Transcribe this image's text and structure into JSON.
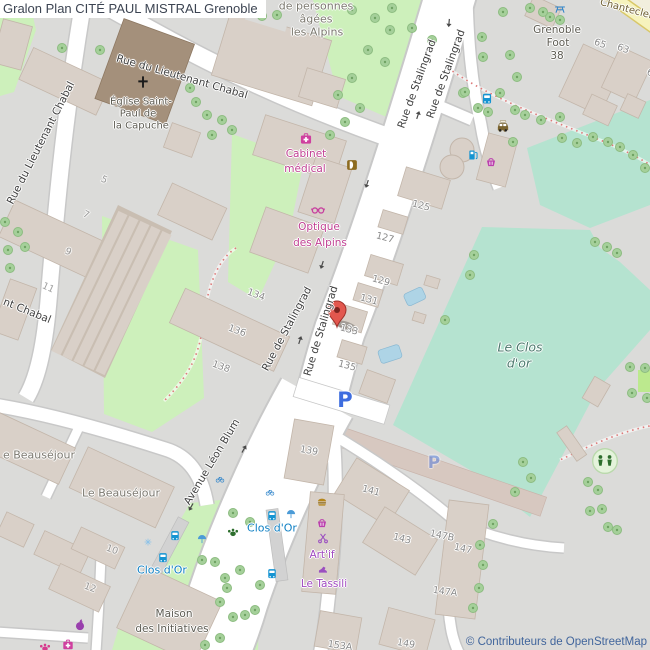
{
  "header": {
    "title": "Gralon Plan CITÉ PAUL MISTRAL Grenoble"
  },
  "attribution": {
    "text": "© Contributeurs de OpenStreetMap"
  },
  "colors": {
    "base": "#dbdbd9",
    "road": "#ffffff",
    "road_casing": "#c8c8c8",
    "building": "#d9d0c8",
    "church": "#a4907b",
    "grass": "#cdf0bb",
    "sports_field": "#b5e3d0",
    "yellow_road": "#f6f3bd",
    "tree": "#a5d09a",
    "pool_blue": "#aed4e6",
    "path_dashed": "#dd7a7a",
    "poi_pink": "#cf3f9f",
    "poi_purple": "#9b4fc0",
    "transit_blue": "#1080c4",
    "parking_blue": "#3e6ddf",
    "marker_red": "#e2574e"
  },
  "map": {
    "marker": {
      "x": 337,
      "y": 327
    },
    "labels": [
      {
        "name": "street-rue-du-lieutenant-chabal-top",
        "text": "Rue du Lieutenant Chabal",
        "x": 182,
        "y": 77,
        "r": 16,
        "cls": "street"
      },
      {
        "name": "street-rue-du-lieutenant-chabal-west",
        "text": "Rue du Lieutenant Chabal",
        "x": 41,
        "y": 143,
        "r": -63,
        "cls": "street"
      },
      {
        "name": "street-nt-chabal",
        "text": "nt Chabal",
        "x": 27,
        "y": 311,
        "r": 22,
        "cls": "street"
      },
      {
        "name": "street-rue-de-stalingrad-nw",
        "text": "Rue de Stalingrad",
        "x": 417,
        "y": 84,
        "r": -70,
        "cls": "street"
      },
      {
        "name": "street-rue-de-stalingrad-ne",
        "text": "Rue de Stalingrad",
        "x": 446,
        "y": 74,
        "r": -70,
        "cls": "street"
      },
      {
        "name": "street-rue-de-stalingrad-sw",
        "text": "Rue de Stalingrad",
        "x": 287,
        "y": 329,
        "r": -62,
        "cls": "street"
      },
      {
        "name": "street-rue-de-stalingrad-se",
        "text": "Rue de Stalingrad",
        "x": 321,
        "y": 331,
        "r": -73,
        "cls": "street"
      },
      {
        "name": "street-avenue-leon-blum",
        "text": "Avenue Léon Blum",
        "x": 212,
        "y": 462,
        "r": -59,
        "cls": "street"
      },
      {
        "name": "street-chanteclerc",
        "text": "Chanteclerc",
        "x": 629,
        "y": 10,
        "r": 15,
        "cls": "chant"
      },
      {
        "name": "place-de-personnes",
        "text": "de personnes",
        "x": 316,
        "y": 6,
        "r": 0,
        "cls": "place"
      },
      {
        "name": "place-agees",
        "text": "âgées",
        "x": 316,
        "y": 19,
        "r": 0,
        "cls": "place"
      },
      {
        "name": "place-les-alpins",
        "text": "les Alpins",
        "x": 317,
        "y": 32,
        "r": 0,
        "cls": "place"
      },
      {
        "name": "place-eglise-line1",
        "text": "Église Saint-",
        "x": 141,
        "y": 102,
        "r": 0,
        "cls": "placedark",
        "size": 10
      },
      {
        "name": "place-eglise-line2",
        "text": "Paul de",
        "x": 138,
        "y": 114,
        "r": 0,
        "cls": "placedark",
        "size": 10
      },
      {
        "name": "place-eglise-line3",
        "text": "la Capuche",
        "x": 141,
        "y": 126,
        "r": 0,
        "cls": "placedark",
        "size": 10
      },
      {
        "name": "place-grenoble-foot-line1",
        "text": "Grenoble",
        "x": 557,
        "y": 30,
        "r": 0,
        "cls": "placedark"
      },
      {
        "name": "place-grenoble-foot-line2",
        "text": "Foot",
        "x": 558,
        "y": 43,
        "r": 0,
        "cls": "placedark"
      },
      {
        "name": "place-grenoble-foot-line3",
        "text": "38",
        "x": 557,
        "y": 56,
        "r": 0,
        "cls": "placedark"
      },
      {
        "name": "area-le-clos-dor-line1",
        "text": "Le Clos",
        "x": 520,
        "y": 347,
        "r": 0,
        "cls": "area"
      },
      {
        "name": "area-le-clos-dor-line2",
        "text": "d'or",
        "x": 519,
        "y": 363,
        "r": 0,
        "cls": "area"
      },
      {
        "name": "place-beausejour-cut",
        "text": "e Beauséjour",
        "x": 39,
        "y": 455,
        "r": 0,
        "cls": "place"
      },
      {
        "name": "place-le-beausejour",
        "text": "Le Beauséjour",
        "x": 121,
        "y": 493,
        "r": 0,
        "cls": "place"
      },
      {
        "name": "place-maison-line1",
        "text": "Maison",
        "x": 174,
        "y": 614,
        "r": 0,
        "cls": "placedark"
      },
      {
        "name": "place-maison-line2",
        "text": "des Initiatives",
        "x": 172,
        "y": 629,
        "r": 0,
        "cls": "placedark"
      },
      {
        "name": "poi-cabinet-line1",
        "text": "Cabinet",
        "x": 306,
        "y": 154,
        "r": 0,
        "cls": "poi"
      },
      {
        "name": "poi-cabinet-line2",
        "text": "médical",
        "x": 305,
        "y": 169,
        "r": 0,
        "cls": "poi"
      },
      {
        "name": "poi-optique-line1",
        "text": "Optique",
        "x": 319,
        "y": 227,
        "r": 0,
        "cls": "poi"
      },
      {
        "name": "poi-optique-line2",
        "text": "des Alpins",
        "x": 320,
        "y": 243,
        "r": 0,
        "cls": "poi"
      },
      {
        "name": "poi-artif",
        "text": "Art'if",
        "x": 322,
        "y": 555,
        "r": 0,
        "cls": "poi2"
      },
      {
        "name": "poi-le-tassili",
        "text": "Le Tassili",
        "x": 324,
        "y": 584,
        "r": 0,
        "cls": "poi2"
      },
      {
        "name": "transit-clos-dor-west",
        "text": "Clos d'Or",
        "x": 162,
        "y": 570,
        "r": 0,
        "cls": "transit"
      },
      {
        "name": "transit-clos-dor-east",
        "text": "Clos d'Or",
        "x": 272,
        "y": 528,
        "r": 0,
        "cls": "transit"
      },
      {
        "name": "parking-p-main",
        "text": "P",
        "x": 345,
        "y": 400,
        "r": 0,
        "cls": "parking"
      },
      {
        "name": "parking-p-faded",
        "text": "P",
        "x": 434,
        "y": 463,
        "r": 0,
        "cls": "parking2"
      },
      {
        "name": "housenumber-65",
        "text": "65",
        "x": 600,
        "y": 44,
        "r": 20,
        "cls": "num"
      },
      {
        "name": "housenumber-63",
        "text": "63",
        "x": 623,
        "y": 49,
        "r": 20,
        "cls": "num"
      },
      {
        "name": "housenumber-6",
        "text": "6",
        "x": 650,
        "y": 73,
        "r": 20,
        "cls": "num"
      },
      {
        "name": "housenumber-125",
        "text": "125",
        "x": 421,
        "y": 206,
        "r": 15,
        "cls": "num"
      },
      {
        "name": "housenumber-127",
        "text": "127",
        "x": 385,
        "y": 238,
        "r": 15,
        "cls": "num"
      },
      {
        "name": "housenumber-129",
        "text": "129",
        "x": 381,
        "y": 281,
        "r": 15,
        "cls": "num"
      },
      {
        "name": "housenumber-131",
        "text": "131",
        "x": 369,
        "y": 300,
        "r": 15,
        "cls": "num"
      },
      {
        "name": "housenumber-133",
        "text": "133",
        "x": 349,
        "y": 330,
        "r": 15,
        "cls": "num"
      },
      {
        "name": "housenumber-135",
        "text": "135",
        "x": 347,
        "y": 366,
        "r": 15,
        "cls": "num"
      },
      {
        "name": "housenumber-134",
        "text": "134",
        "x": 256,
        "y": 295,
        "r": 20,
        "cls": "num"
      },
      {
        "name": "housenumber-136",
        "text": "136",
        "x": 237,
        "y": 331,
        "r": 20,
        "cls": "num"
      },
      {
        "name": "housenumber-138",
        "text": "138",
        "x": 221,
        "y": 367,
        "r": 20,
        "cls": "num"
      },
      {
        "name": "housenumber-139",
        "text": "139",
        "x": 309,
        "y": 451,
        "r": 10,
        "cls": "num"
      },
      {
        "name": "housenumber-141",
        "text": "141",
        "x": 371,
        "y": 491,
        "r": 15,
        "cls": "num"
      },
      {
        "name": "housenumber-143",
        "text": "143",
        "x": 402,
        "y": 539,
        "r": 15,
        "cls": "num"
      },
      {
        "name": "housenumber-147B",
        "text": "147B",
        "x": 442,
        "y": 536,
        "r": 12,
        "cls": "num"
      },
      {
        "name": "housenumber-147",
        "text": "147",
        "x": 463,
        "y": 549,
        "r": 12,
        "cls": "num"
      },
      {
        "name": "housenumber-147A",
        "text": "147A",
        "x": 445,
        "y": 592,
        "r": 8,
        "cls": "num"
      },
      {
        "name": "housenumber-149",
        "text": "149",
        "x": 406,
        "y": 644,
        "r": 10,
        "cls": "num"
      },
      {
        "name": "housenumber-153A",
        "text": "153A",
        "x": 340,
        "y": 646,
        "r": 8,
        "cls": "num"
      },
      {
        "name": "housenumber-5",
        "text": "5",
        "x": 104,
        "y": 180,
        "r": 25,
        "cls": "num",
        "op": 0.8
      },
      {
        "name": "housenumber-7",
        "text": "7",
        "x": 86,
        "y": 215,
        "r": 25,
        "cls": "num",
        "op": 0.8
      },
      {
        "name": "housenumber-9",
        "text": "9",
        "x": 68,
        "y": 252,
        "r": 25,
        "cls": "num",
        "op": 0.8
      },
      {
        "name": "housenumber-11",
        "text": "11",
        "x": 48,
        "y": 288,
        "r": 25,
        "cls": "num",
        "op": 0.8
      },
      {
        "name": "housenumber-10",
        "text": "10",
        "x": 112,
        "y": 550,
        "r": 20,
        "cls": "num",
        "op": 0.8
      },
      {
        "name": "housenumber-12",
        "text": "12",
        "x": 90,
        "y": 588,
        "r": 20,
        "cls": "num",
        "op": 0.8
      }
    ],
    "icons": [
      {
        "name": "church-cross-icon",
        "sym": "cross",
        "x": 143,
        "y": 82,
        "size": 15
      },
      {
        "name": "medical-kit-icon",
        "sym": "medkit",
        "x": 306,
        "y": 139,
        "size": 14
      },
      {
        "name": "kebab-icon",
        "sym": "kebab",
        "x": 352,
        "y": 165,
        "size": 13
      },
      {
        "name": "glasses-icon",
        "sym": "glasses",
        "x": 318,
        "y": 210,
        "size": 15
      },
      {
        "name": "bus-stop-icon-1",
        "sym": "bus",
        "x": 487,
        "y": 99,
        "size": 13
      },
      {
        "name": "taxi-icon",
        "sym": "taxi",
        "x": 503,
        "y": 127,
        "size": 15
      },
      {
        "name": "fuel-station-icon",
        "sym": "fuel",
        "x": 473,
        "y": 155,
        "size": 13
      },
      {
        "name": "supermarket-basket-icon",
        "sym": "basket",
        "x": 491,
        "y": 162,
        "size": 13
      },
      {
        "name": "picnic-table-icon",
        "sym": "picnic",
        "x": 560,
        "y": 9,
        "size": 13
      },
      {
        "name": "playground-icon",
        "sym": "playground",
        "x": 605,
        "y": 461,
        "size": 27
      },
      {
        "name": "dog-park-paw-icon",
        "sym": "paw",
        "x": 233,
        "y": 532,
        "size": 13,
        "color": "#2d6e2d"
      },
      {
        "name": "tram-stop-icon-1",
        "sym": "bus",
        "x": 175,
        "y": 536,
        "size": 12
      },
      {
        "name": "tram-stop-icon-2",
        "sym": "bus",
        "x": 163,
        "y": 558,
        "size": 12
      },
      {
        "name": "bus-stop-icon-2",
        "sym": "bus",
        "x": 272,
        "y": 516,
        "size": 12
      },
      {
        "name": "bus-stop-icon-3",
        "sym": "bus",
        "x": 272,
        "y": 574,
        "size": 12
      },
      {
        "name": "shelter-icon-1",
        "sym": "shelter",
        "x": 291,
        "y": 514,
        "size": 12
      },
      {
        "name": "shelter-icon-2",
        "sym": "shelter",
        "x": 202,
        "y": 539,
        "size": 12
      },
      {
        "name": "fountain-icon",
        "sym": "fountain",
        "x": 148,
        "y": 542,
        "size": 10
      },
      {
        "name": "bicycle-parking-icon-1",
        "sym": "bicycle",
        "x": 270,
        "y": 492,
        "size": 10
      },
      {
        "name": "bicycle-parking-icon-2",
        "sym": "bicycle",
        "x": 220,
        "y": 479,
        "size": 10
      },
      {
        "name": "fast-food-icon",
        "sym": "burger",
        "x": 322,
        "y": 503,
        "size": 13
      },
      {
        "name": "shop-basket-icon",
        "sym": "basket",
        "x": 322,
        "y": 523,
        "size": 13
      },
      {
        "name": "hairdresser-scissors-icon",
        "sym": "scissors",
        "x": 323,
        "y": 538,
        "size": 13
      },
      {
        "name": "shoe-shop-icon",
        "sym": "shoe",
        "x": 323,
        "y": 569,
        "size": 13
      },
      {
        "name": "greengrocer-apple-icon",
        "sym": "apple",
        "x": 80,
        "y": 625,
        "size": 14
      },
      {
        "name": "pet-shop-paw-icon",
        "sym": "paw",
        "x": 45,
        "y": 647,
        "size": 13,
        "color": "#d63a8e"
      },
      {
        "name": "pharmacy-kit-icon",
        "sym": "medkit",
        "x": 68,
        "y": 645,
        "size": 13
      },
      {
        "name": "oneway-arrow-icon-1",
        "sym": "arrow",
        "x": 367,
        "y": 184,
        "r": 108,
        "size": 12
      },
      {
        "name": "oneway-arrow-icon-2",
        "sym": "arrow",
        "x": 322,
        "y": 265,
        "r": 108,
        "size": 12
      },
      {
        "name": "oneway-arrow-icon-3",
        "sym": "arrow",
        "x": 300,
        "y": 340,
        "r": -72,
        "size": 12
      },
      {
        "name": "oneway-arrow-icon-4",
        "sym": "arrow",
        "x": 418,
        "y": 115,
        "r": -72,
        "size": 12
      },
      {
        "name": "oneway-arrow-icon-5",
        "sym": "arrow",
        "x": 449,
        "y": 23,
        "r": 95,
        "size": 12
      },
      {
        "name": "oneway-arrow-icon-6",
        "sym": "arrow",
        "x": 244,
        "y": 449,
        "r": -60,
        "size": 12
      },
      {
        "name": "oneway-arrow-icon-7",
        "sym": "arrow",
        "x": 191,
        "y": 507,
        "r": 120,
        "size": 12
      }
    ],
    "trees": [
      [
        262,
        16
      ],
      [
        277,
        15
      ],
      [
        352,
        10
      ],
      [
        375,
        18
      ],
      [
        392,
        8
      ],
      [
        390,
        30
      ],
      [
        412,
        28
      ],
      [
        432,
        40
      ],
      [
        368,
        50
      ],
      [
        385,
        62
      ],
      [
        352,
        78
      ],
      [
        338,
        95
      ],
      [
        360,
        108
      ],
      [
        345,
        122
      ],
      [
        330,
        135
      ],
      [
        482,
        37
      ],
      [
        503,
        12
      ],
      [
        530,
        8
      ],
      [
        550,
        17
      ],
      [
        483,
        57
      ],
      [
        510,
        55
      ],
      [
        517,
        77
      ],
      [
        500,
        93
      ],
      [
        463,
        93
      ],
      [
        515,
        110
      ],
      [
        488,
        112
      ],
      [
        513,
        142
      ],
      [
        465,
        92
      ],
      [
        478,
        108
      ],
      [
        543,
        12
      ],
      [
        560,
        20
      ],
      [
        560,
        117
      ],
      [
        577,
        143
      ],
      [
        593,
        137
      ],
      [
        608,
        142
      ],
      [
        620,
        147
      ],
      [
        633,
        155
      ],
      [
        645,
        168
      ],
      [
        562,
        138
      ],
      [
        525,
        115
      ],
      [
        541,
        120
      ],
      [
        190,
        88
      ],
      [
        196,
        102
      ],
      [
        207,
        115
      ],
      [
        222,
        120
      ],
      [
        232,
        130
      ],
      [
        212,
        135
      ],
      [
        62,
        48
      ],
      [
        100,
        50
      ],
      [
        5,
        222
      ],
      [
        18,
        232
      ],
      [
        8,
        250
      ],
      [
        25,
        247
      ],
      [
        10,
        268
      ],
      [
        588,
        482
      ],
      [
        590,
        511
      ],
      [
        602,
        509
      ],
      [
        608,
        527
      ],
      [
        617,
        530
      ],
      [
        630,
        367
      ],
      [
        645,
        368
      ],
      [
        632,
        393
      ],
      [
        647,
        398
      ],
      [
        598,
        490
      ],
      [
        523,
        462
      ],
      [
        531,
        478
      ],
      [
        515,
        492
      ],
      [
        480,
        545
      ],
      [
        483,
        565
      ],
      [
        479,
        588
      ],
      [
        473,
        608
      ],
      [
        493,
        524
      ],
      [
        595,
        242
      ],
      [
        607,
        247
      ],
      [
        617,
        253
      ],
      [
        474,
        255
      ],
      [
        470,
        275
      ],
      [
        445,
        320
      ],
      [
        202,
        560
      ],
      [
        215,
        562
      ],
      [
        225,
        578
      ],
      [
        240,
        570
      ],
      [
        227,
        588
      ],
      [
        220,
        602
      ],
      [
        233,
        617
      ],
      [
        205,
        645
      ],
      [
        245,
        615
      ],
      [
        220,
        638
      ],
      [
        250,
        522
      ],
      [
        233,
        513
      ],
      [
        260,
        585
      ],
      [
        255,
        610
      ]
    ]
  }
}
